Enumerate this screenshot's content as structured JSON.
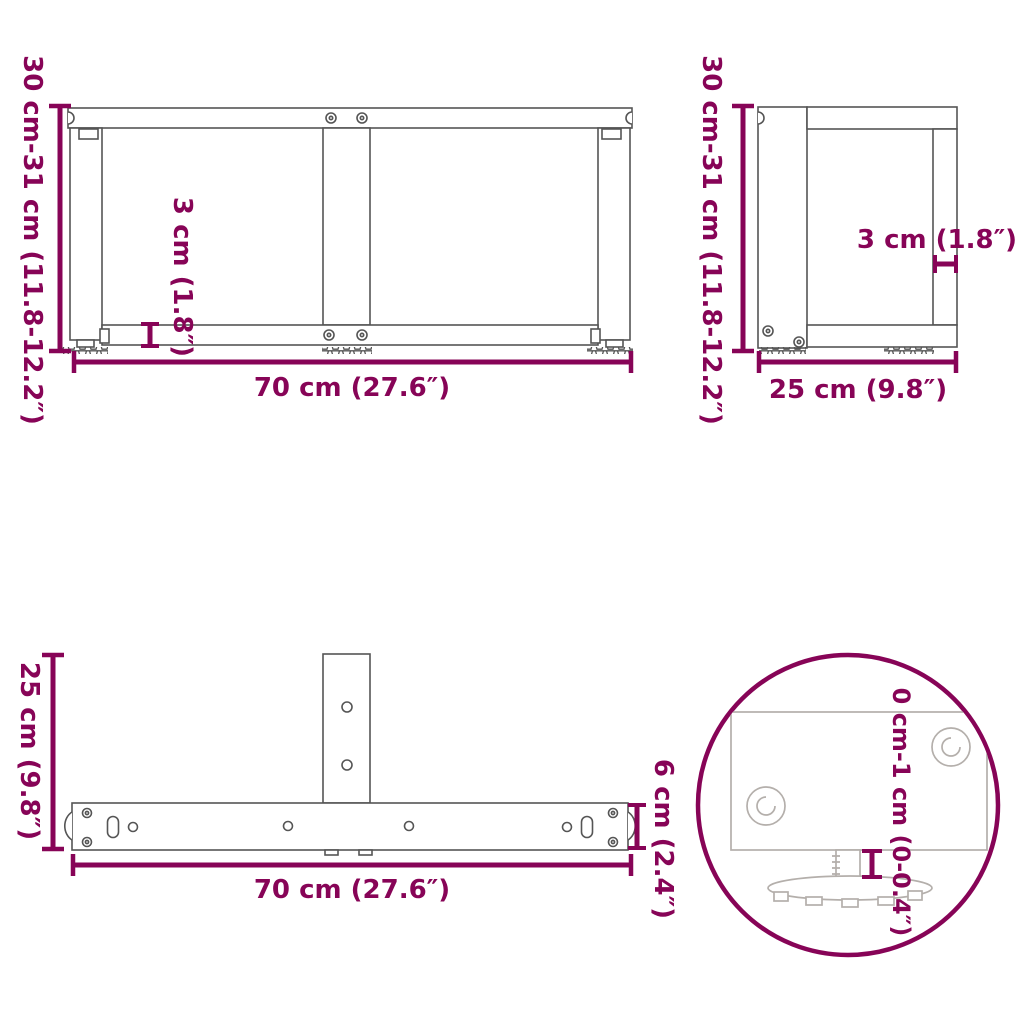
{
  "title": "T-shape table legs dimension diagram",
  "colors": {
    "dimension_accent": "#870457",
    "drawing_line": "#555555",
    "detail_line": "#b4afab",
    "background": "#ffffff"
  },
  "views": {
    "front": {
      "name": "front view",
      "height_label": "30 cm-31 cm (11.8-12.2″)",
      "width_label": "70 cm (27.6″)",
      "rail_thickness_label": "3 cm (1.8″)"
    },
    "side": {
      "name": "side view",
      "height_label": "30 cm-31 cm (11.8-12.2″)",
      "depth_label": "25 cm (9.8″)",
      "frame_thickness_label": "3 cm (1.8″)"
    },
    "top": {
      "name": "top view",
      "depth_label": "25 cm (9.8″)",
      "width_label": "70 cm (27.6″)",
      "bar_width_label": "6 cm (2.4″)"
    },
    "detail": {
      "name": "adjustable foot detail",
      "adjustment_range_label": "0 cm-1 cm (0-0.4″)"
    }
  }
}
